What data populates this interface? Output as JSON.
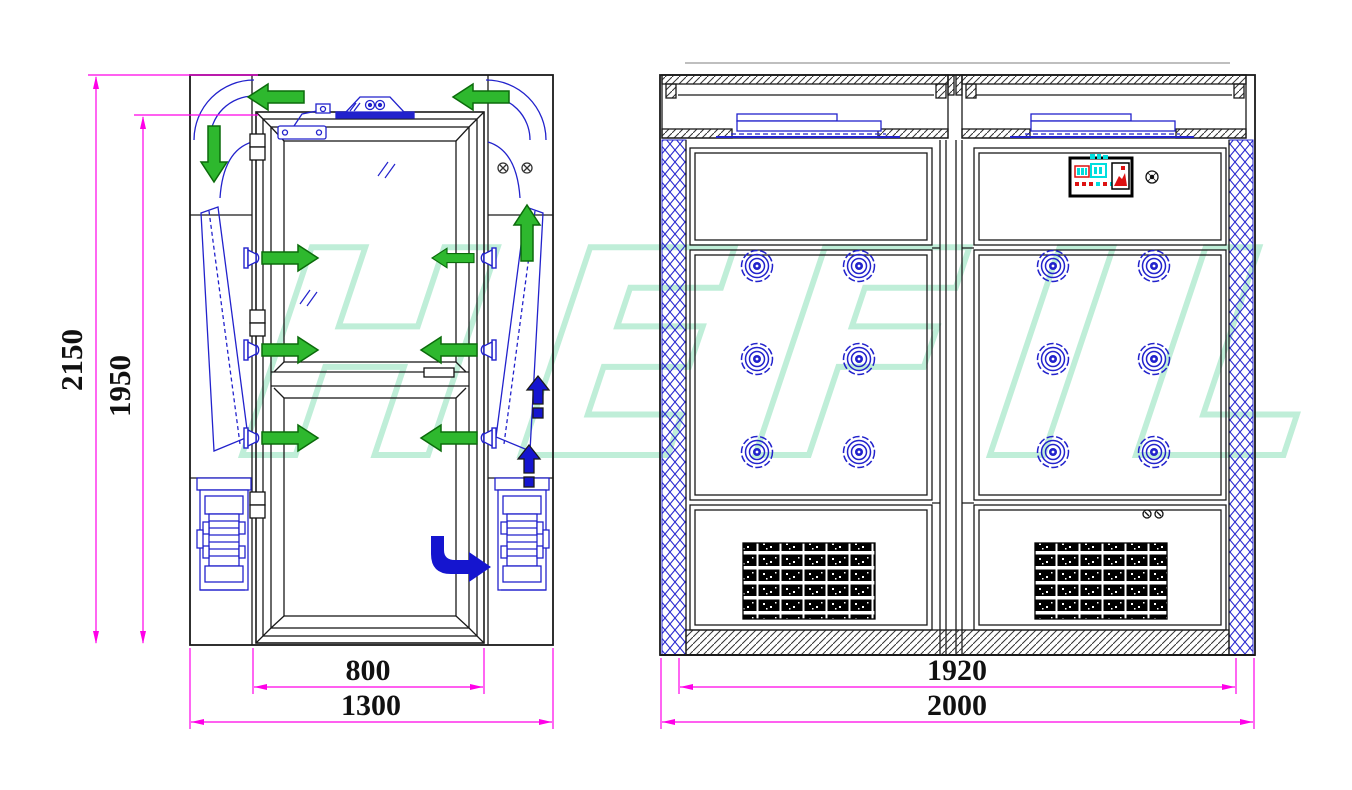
{
  "watermark": {
    "text": "HEFIL",
    "color": "#bfeed8"
  },
  "palette": {
    "structure": "#1a1a1a",
    "component_blue": "#2222cc",
    "dimension_magenta": "#ff00e8",
    "arrow_green": "#2eb82e",
    "arrow_green_outline": "#0b6b0b",
    "arrow_blue": "#1515cf",
    "display_cyan": "#00dede",
    "display_red": "#dd1111"
  },
  "front_view": {
    "dimensions": {
      "overall_height": "2150",
      "door_height": "1950",
      "door_width": "800",
      "overall_width": "1300"
    }
  },
  "interior_view": {
    "panels": 2,
    "nozzles_per_panel": 6,
    "dimensions": {
      "chamber_width": "1920",
      "overall_width": "2000"
    }
  }
}
